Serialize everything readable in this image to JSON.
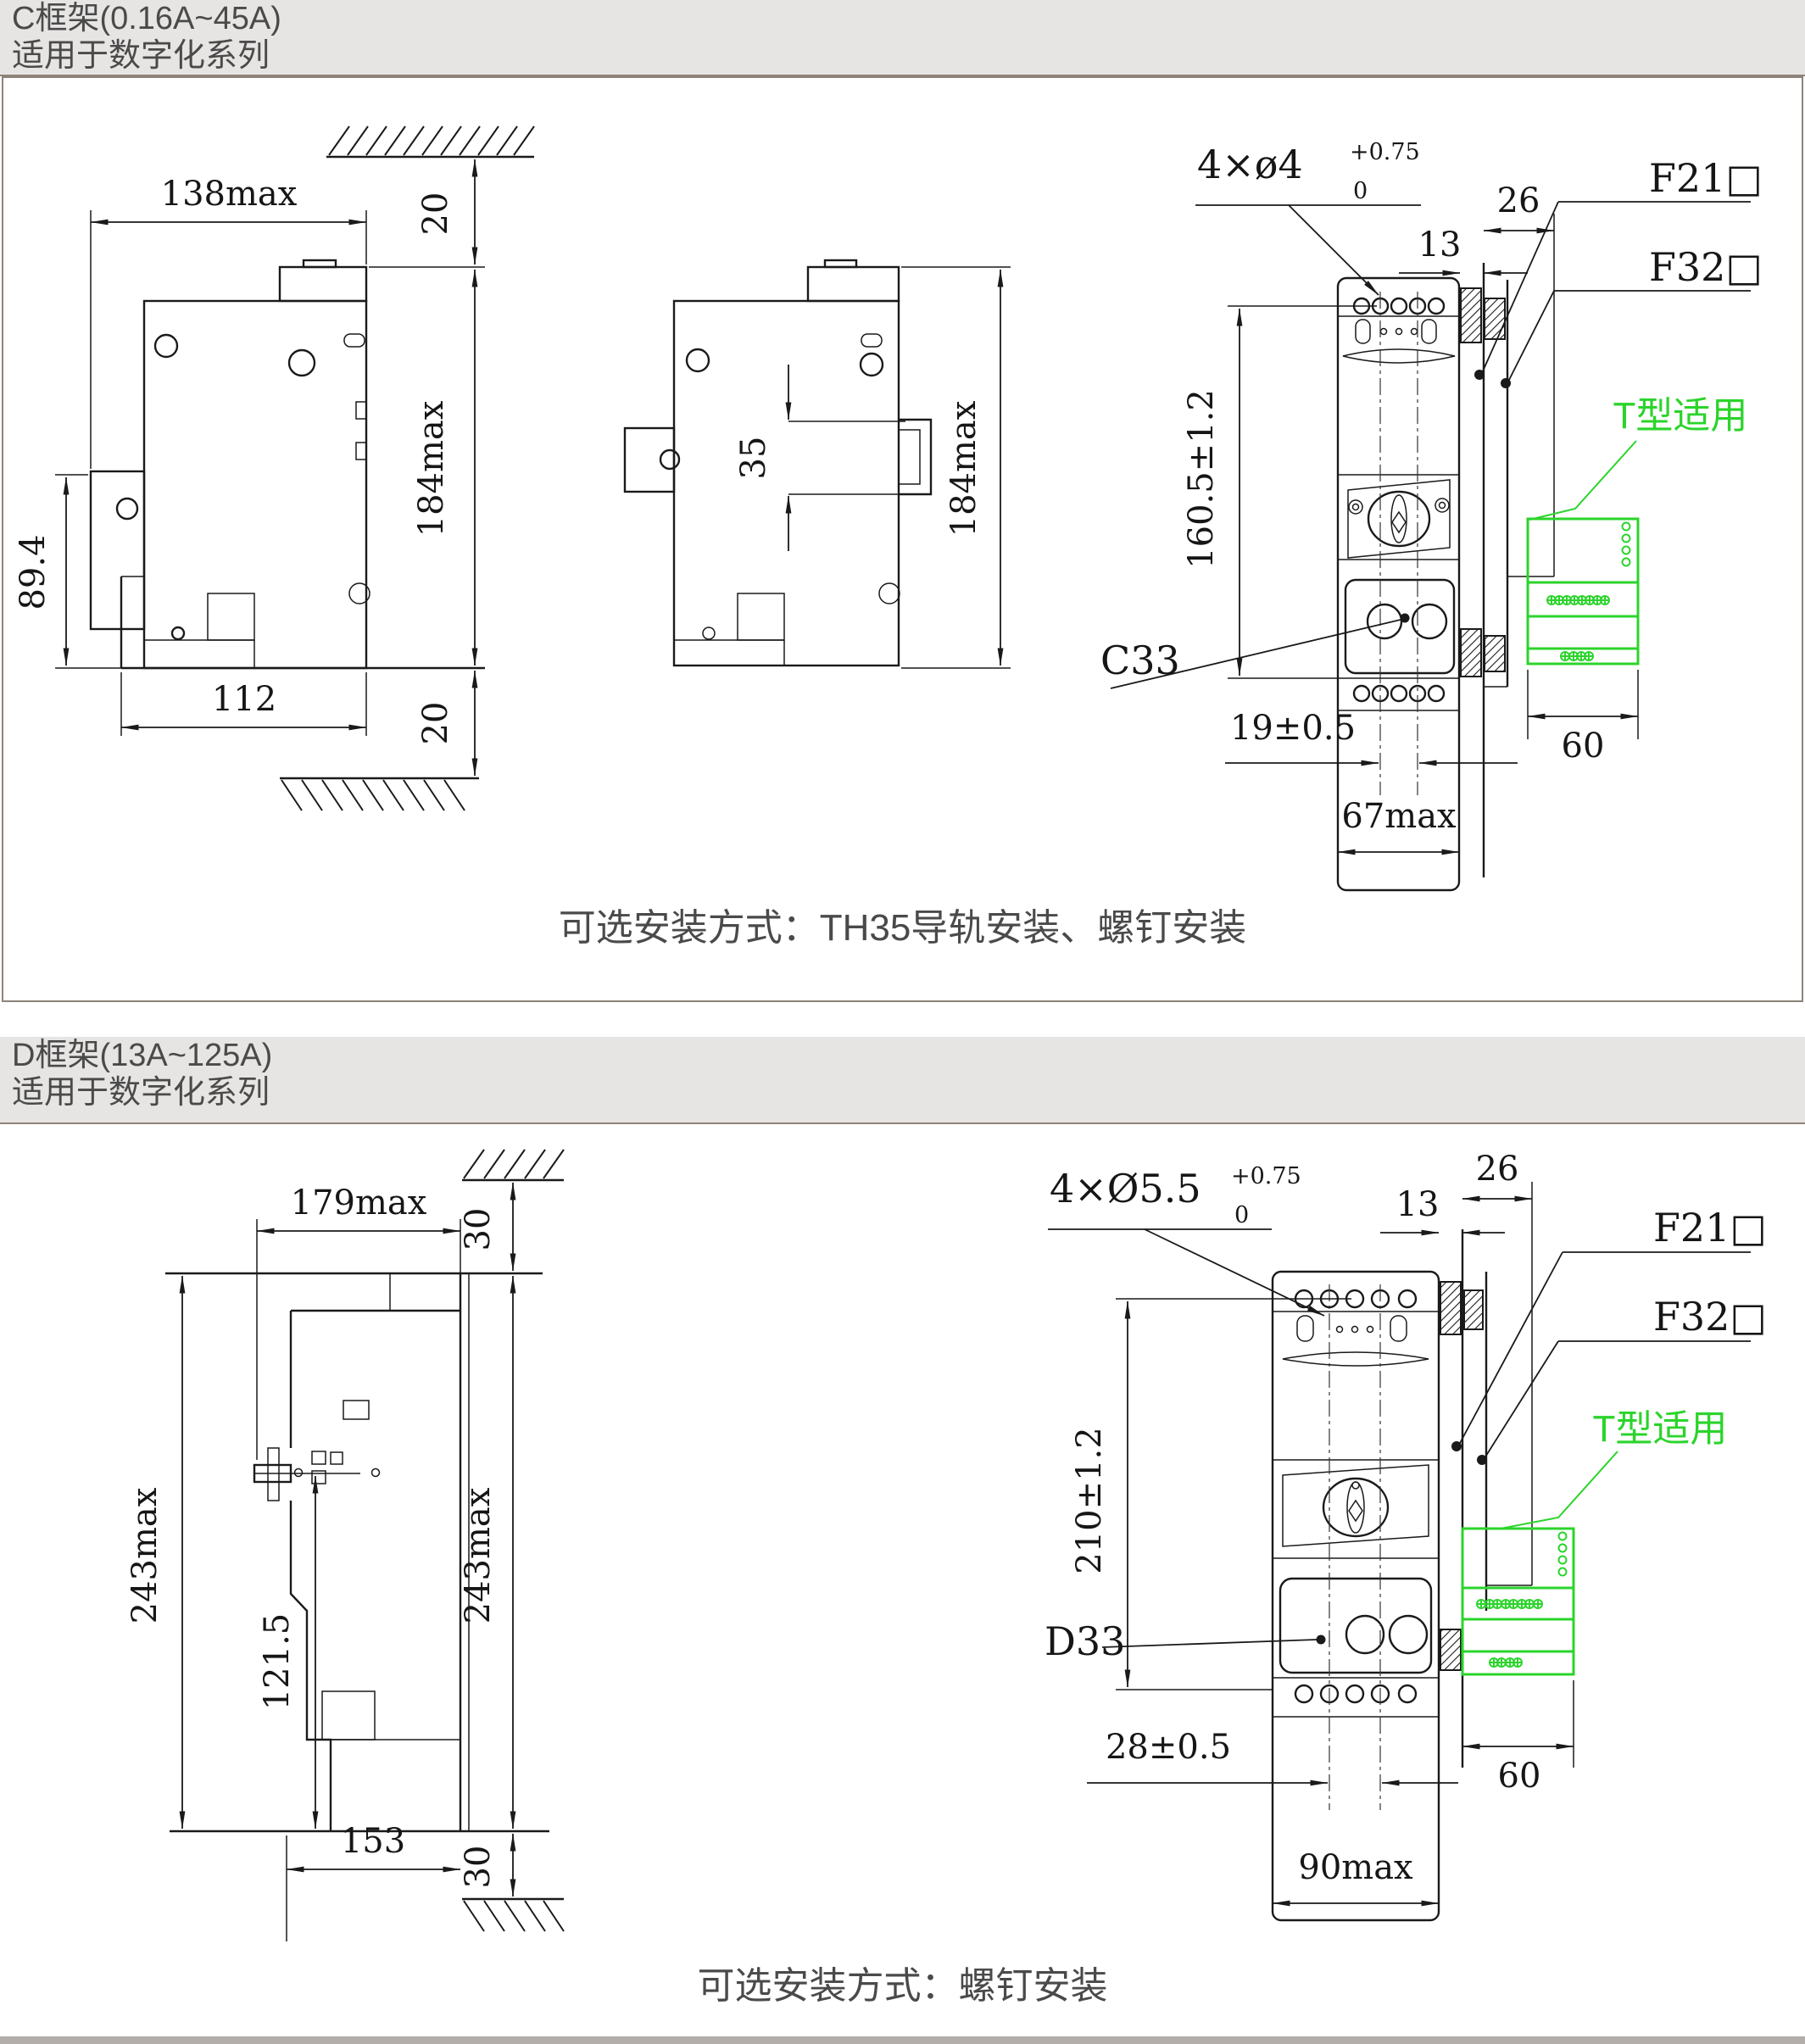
{
  "colors": {
    "line": "#1a1a1a",
    "accent_green": "#2bd42b",
    "header_band_bg": "#e7e5e4",
    "header_text": "#4a4a4a",
    "box_border": "#8d8379"
  },
  "sections": [
    {
      "header_line1": "C框架(0.16A~45A)",
      "header_line2": "适用于数字化系列",
      "caption": "可选安装方式：TH35导轨安装、螺钉安装",
      "side_view": {
        "width": "138max",
        "top_gap": "20",
        "height": "184max",
        "lug_height": "89.4",
        "base_width": "112",
        "bottom_gap": "20"
      },
      "rail_view": {
        "rail_pitch": "35",
        "height": "184max"
      },
      "front_view": {
        "holes_prefix": "4×ø4",
        "holes_tol_upper": "+0.75",
        "holes_tol_lower": "0",
        "depth_inner": "13",
        "depth_outer": "26",
        "mount_height": "160.5±1.2",
        "product_code": "C33",
        "terminal_pitch": "19±0.5",
        "accessory_width": "60",
        "width": "67max",
        "accessory_top": "F21□",
        "accessory_bottom": "F32□",
        "t_type_note": "T型适用"
      }
    },
    {
      "header_line1": "D框架(13A~125A)",
      "header_line2": "适用于数字化系列",
      "caption": "可选安装方式：螺钉安装",
      "side_view": {
        "width": "179max",
        "top_gap": "30",
        "height_left": "243max",
        "height_right": "243max",
        "lug_height": "121.5",
        "base_width": "153",
        "bottom_gap": "30"
      },
      "front_view": {
        "holes_prefix": "4×Ø5.5",
        "holes_tol_upper": "+0.75",
        "holes_tol_lower": "0",
        "depth_inner": "13",
        "depth_outer": "26",
        "mount_height": "210±1.2",
        "product_code": "D33",
        "terminal_pitch": "28±0.5",
        "accessory_width": "60",
        "width": "90max",
        "accessory_top": "F21□",
        "accessory_bottom": "F32□",
        "t_type_note": "T型适用"
      }
    }
  ]
}
